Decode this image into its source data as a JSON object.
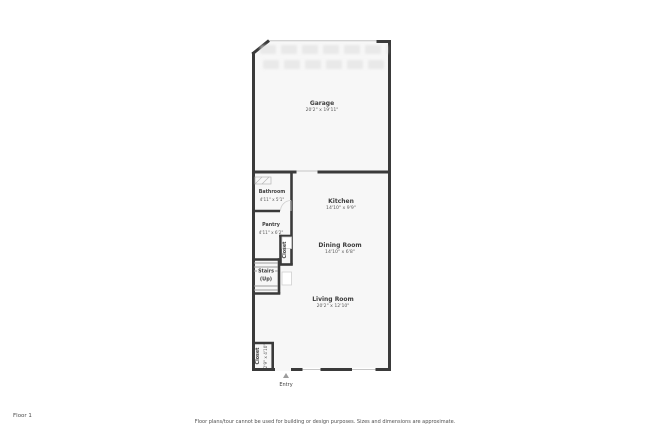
{
  "page": {
    "floor_label": "Floor 1",
    "disclaimer": "Floor plans/tour cannot be used for building or design purposes. Sizes and dimensions are approximate."
  },
  "rooms": {
    "garage": {
      "name": "Garage",
      "dims": "20'2\" x 19'11\""
    },
    "bathroom": {
      "name": "Bathroom",
      "dims": "4'11\" x 5'1\""
    },
    "kitchen": {
      "name": "Kitchen",
      "dims": "14'10\" x 9'9\""
    },
    "pantry": {
      "name": "Pantry",
      "dims": "4'11\" x 6'2\""
    },
    "closet": {
      "name": "Closet"
    },
    "dining": {
      "name": "Dining Room",
      "dims": "14'10\" x 6'8\""
    },
    "stairs": {
      "name": "Stairs",
      "sub": "(Up)"
    },
    "living": {
      "name": "Living Room",
      "dims": "20'2\" x 12'10\""
    },
    "entry_closet": {
      "name": "Closet",
      "dims": "2'9\" x 4'10\""
    },
    "entry": {
      "name": "Entry"
    }
  },
  "colors": {
    "wall": "#3a3a3a",
    "room_fill": "#f7f7f7",
    "light_line": "#c6c6c6",
    "label_text": "#3d3d3d",
    "muted_text": "#595959"
  }
}
